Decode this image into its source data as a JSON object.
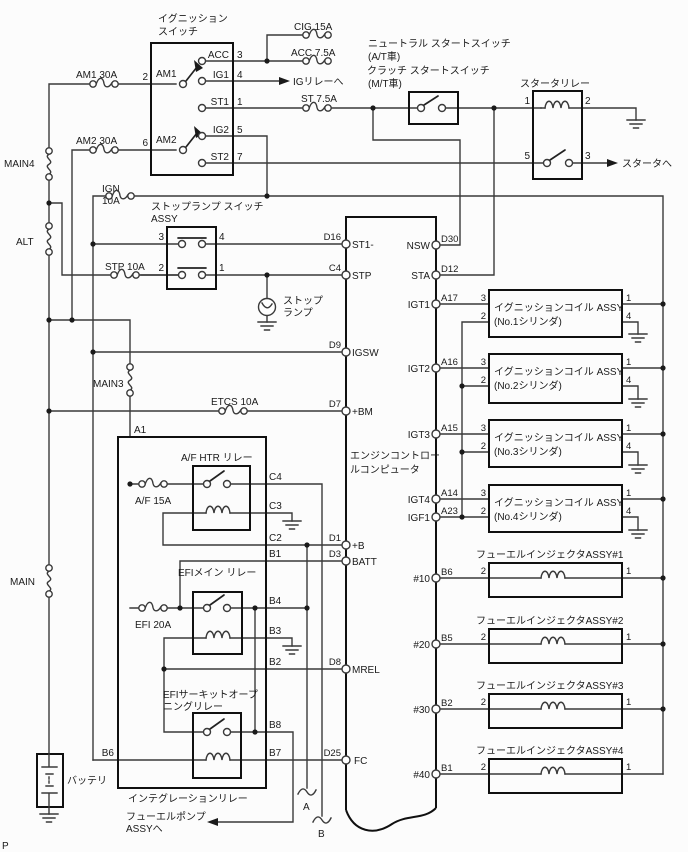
{
  "page": {
    "corner_mark": "P"
  },
  "left_rail": {
    "main4": "MAIN4",
    "alt": "ALT",
    "main": "MAIN",
    "main3": "MAIN3",
    "battery": "バッテリ"
  },
  "fuses": {
    "am1": "AM1 30A",
    "am2": "AM2 30A",
    "cig": "CIG 15A",
    "acc": "ACC 7.5A",
    "st": "ST 7.5A",
    "ign_name": "IGN",
    "ign_rating": "10A",
    "stp": "STP 10A",
    "etcs": "ETCS 10A",
    "af": "A/F 15A",
    "efi": "EFI 20A"
  },
  "ignition_switch": {
    "title_line1": "イグニッション",
    "title_line2": "スイッチ",
    "t_am1": "AM1",
    "t_am2": "AM2",
    "t_acc": "ACC",
    "t_ig1": "IG1",
    "t_st1": "ST1",
    "t_ig2": "IG2",
    "t_st2": "ST2",
    "n2": "2",
    "n6": "6",
    "n3": "3",
    "n4": "4",
    "n1": "1",
    "n5": "5",
    "n7": "7"
  },
  "notes": {
    "to_ig_relay": "IGリレーへ",
    "to_starter": "スタータへ",
    "to_fuel_pump_line1": "フューエルポンプ",
    "to_fuel_pump_line2": "ASSYへ"
  },
  "neutral_start_switch": {
    "line1": "ニュートラル スタートスイッチ",
    "line2": "(A/T車)",
    "line3": "クラッチ スタートスイッチ",
    "line4": "(M/T車)"
  },
  "starter_relay": {
    "title": "スタータリレー",
    "p1": "1",
    "p2": "2",
    "p5": "5",
    "p3": "3"
  },
  "stop_lamp_switch": {
    "title_line1": "ストップランプ スイッチ",
    "title_line2": "ASSY",
    "p3": "3",
    "p4": "4",
    "p2": "2",
    "p1": "1"
  },
  "stop_lamp": {
    "line1": "ストップ",
    "line2": "ランプ"
  },
  "ecu": {
    "name_line1": "エンジンコントロー",
    "name_line2": "ルコンピュータ",
    "left_pins": [
      {
        "code": "D16",
        "name": "ST1-"
      },
      {
        "code": "C4",
        "name": "STP"
      },
      {
        "code": "D9",
        "name": "IGSW"
      },
      {
        "code": "D7",
        "name": "+BM"
      },
      {
        "code": "D1",
        "name": "+B"
      },
      {
        "code": "D3",
        "name": "BATT"
      },
      {
        "code": "D8",
        "name": "MREL"
      },
      {
        "code": "D25",
        "name": "FC"
      }
    ],
    "right_pins": [
      {
        "code": "D30",
        "name": "NSW"
      },
      {
        "code": "D12",
        "name": "STA"
      },
      {
        "code": "A17",
        "name": "IGT1"
      },
      {
        "code": "A16",
        "name": "IGT2"
      },
      {
        "code": "A15",
        "name": "IGT3"
      },
      {
        "code": "A14",
        "name": "IGT4"
      },
      {
        "code": "A23",
        "name": "IGF1"
      },
      {
        "code": "B6",
        "name": "#10"
      },
      {
        "code": "B5",
        "name": "#20"
      },
      {
        "code": "B2",
        "name": "#30"
      },
      {
        "code": "B1",
        "name": "#40"
      }
    ]
  },
  "ignition_coils": {
    "p3": "3",
    "p2": "2",
    "p1": "1",
    "p4": "4",
    "items": [
      {
        "line1": "イグニッションコイル ASSY",
        "line2": "(No.1シリンダ)"
      },
      {
        "line1": "イグニッションコイル ASSY",
        "line2": "(No.2シリンダ)"
      },
      {
        "line1": "イグニッションコイル ASSY",
        "line2": "(No.3シリンダ)"
      },
      {
        "line1": "イグニッションコイル ASSY",
        "line2": "(No.4シリンダ)"
      }
    ]
  },
  "injectors": {
    "p2": "2",
    "p1": "1",
    "items": [
      {
        "title": "フューエルインジェクタASSY#1"
      },
      {
        "title": "フューエルインジェクタASSY#2"
      },
      {
        "title": "フューエルインジェクタASSY#3"
      },
      {
        "title": "フューエルインジェクタASSY#4"
      }
    ]
  },
  "integration_relay": {
    "title": "インテグレーションリレー",
    "af_relay_title": "A/F HTR リレー",
    "efi_relay_title": "EFIメイン リレー",
    "co_relay_line1": "EFIサーキットオープ",
    "co_relay_line2": "ニングリレー",
    "a1": "A1",
    "b6": "B6",
    "c4": "C4",
    "c3": "C3",
    "c2": "C2",
    "b1": "B1",
    "b4": "B4",
    "b3": "B3",
    "b2": "B2",
    "b8": "B8",
    "b7": "B7"
  },
  "connectors": {
    "a": "A",
    "b": "B"
  },
  "colors": {
    "wire": "#3a3a3a",
    "box": "#101010",
    "text": "#1a1a1a",
    "background": "#fcfcfc"
  }
}
